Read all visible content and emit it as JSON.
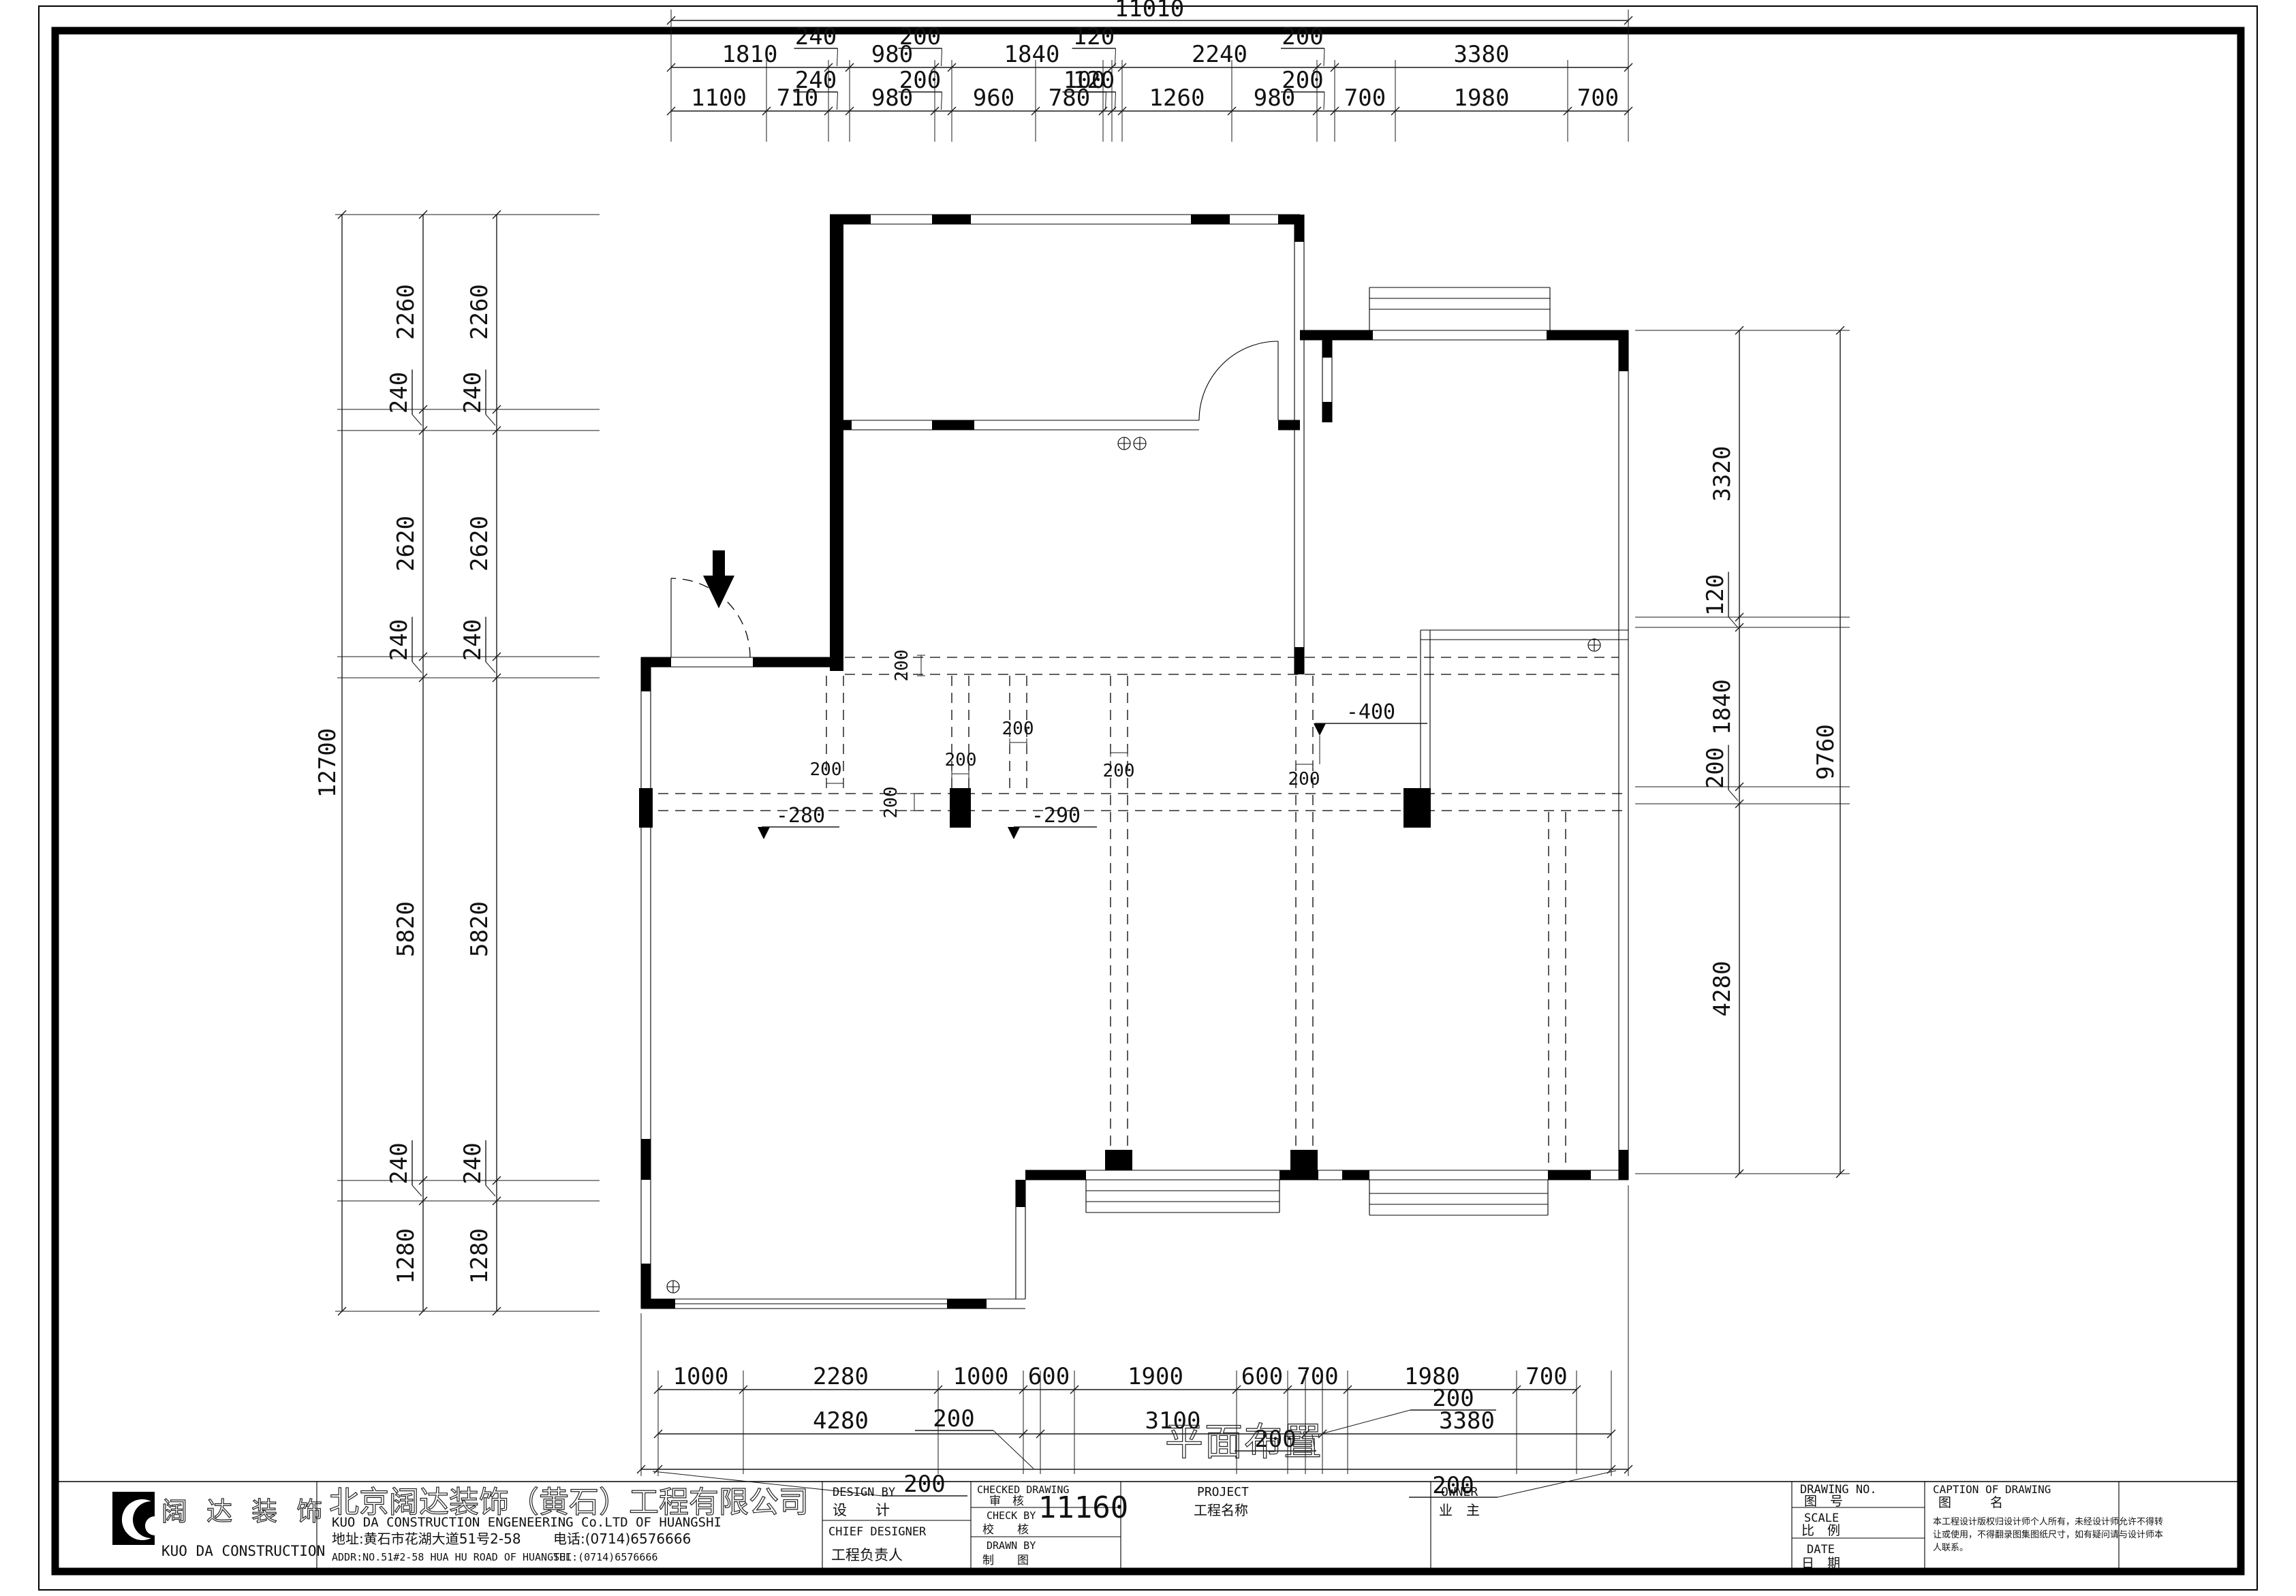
{
  "dims": {
    "top": {
      "overall": "11010",
      "row1": [
        "1810",
        "240",
        "980",
        "200",
        "1840",
        "120",
        "2240",
        "200",
        "3380"
      ],
      "row2": [
        "1100",
        "710",
        "240",
        "980",
        "200",
        "960",
        "780",
        "100",
        "120",
        "1260",
        "980",
        "200",
        "700",
        "1980",
        "700"
      ]
    },
    "left": {
      "overall": "12700",
      "chain": [
        "2260",
        "240",
        "2620",
        "240",
        "5820",
        "240",
        "1280"
      ]
    },
    "right": {
      "overall": "9760",
      "chain": [
        "3320",
        "120",
        "1840",
        "200",
        "4280"
      ]
    },
    "bottom": {
      "row1": [
        "1000",
        "2280",
        "1000",
        "600",
        "1900",
        "600",
        "700",
        "1980",
        "700"
      ],
      "row2": [
        "4280",
        "200",
        "3100",
        "200",
        "3380"
      ],
      "row3": [
        "200",
        "11160",
        "200"
      ]
    }
  },
  "plan": {
    "title": "平面布置",
    "gap_label": "200",
    "levels": {
      "m280": "-280",
      "m290": "-290",
      "m400": "-400"
    }
  },
  "titleblock": {
    "logo_cn": "阔 达 装 饰",
    "logo_en": "KUO DA CONSTRUCTION",
    "company_cn": "北京阔达装饰（黄石）工程有限公司",
    "company_en": "KUO DA CONSTRUCTION ENGENEERING Co.LTD OF HUANGSHI",
    "address_cn": "地址:黄石市花湖大道51号2-58",
    "phone_cn": "电话:(0714)6576666",
    "address_en": "ADDR:NO.51#2-58 HUA HU ROAD OF HUANGSHI",
    "phone_en": "TEL:(0714)6576666",
    "design_by_en": "DESIGN BY",
    "design_by_cn": "设　　计",
    "chief_designer_en": "CHIEF DESIGNER",
    "chief_designer_cn": "工程负责人",
    "checked_drawing_en": "CHECKED DRAWING",
    "checked_drawing_cn": "审　核",
    "check_by_en": "CHECK BY",
    "check_by_cn": "校　　核",
    "drawn_by_en": "DRAWN BY",
    "drawn_by_cn": "制　　图",
    "project_en": "PROJECT",
    "project_cn": "工程名称",
    "owner_en": "OWNER",
    "owner_cn": "业　主",
    "drawing_no_en": "DRAWING NO.",
    "drawing_no_cn": "图　号",
    "scale_en": "SCALE",
    "scale_cn": "比　例",
    "date_en": "DATE",
    "date_cn": "日　期",
    "caption_en": "CAPTION OF DRAWING",
    "caption_cn": "图　　　名",
    "disclaimer1": "本工程设计版权归设计师个人所有，未经设计师允许不得转",
    "disclaimer2": "让或使用，不得翻录图集图纸尺寸，如有疑问请与设计师本",
    "disclaimer3": "人联系。"
  }
}
